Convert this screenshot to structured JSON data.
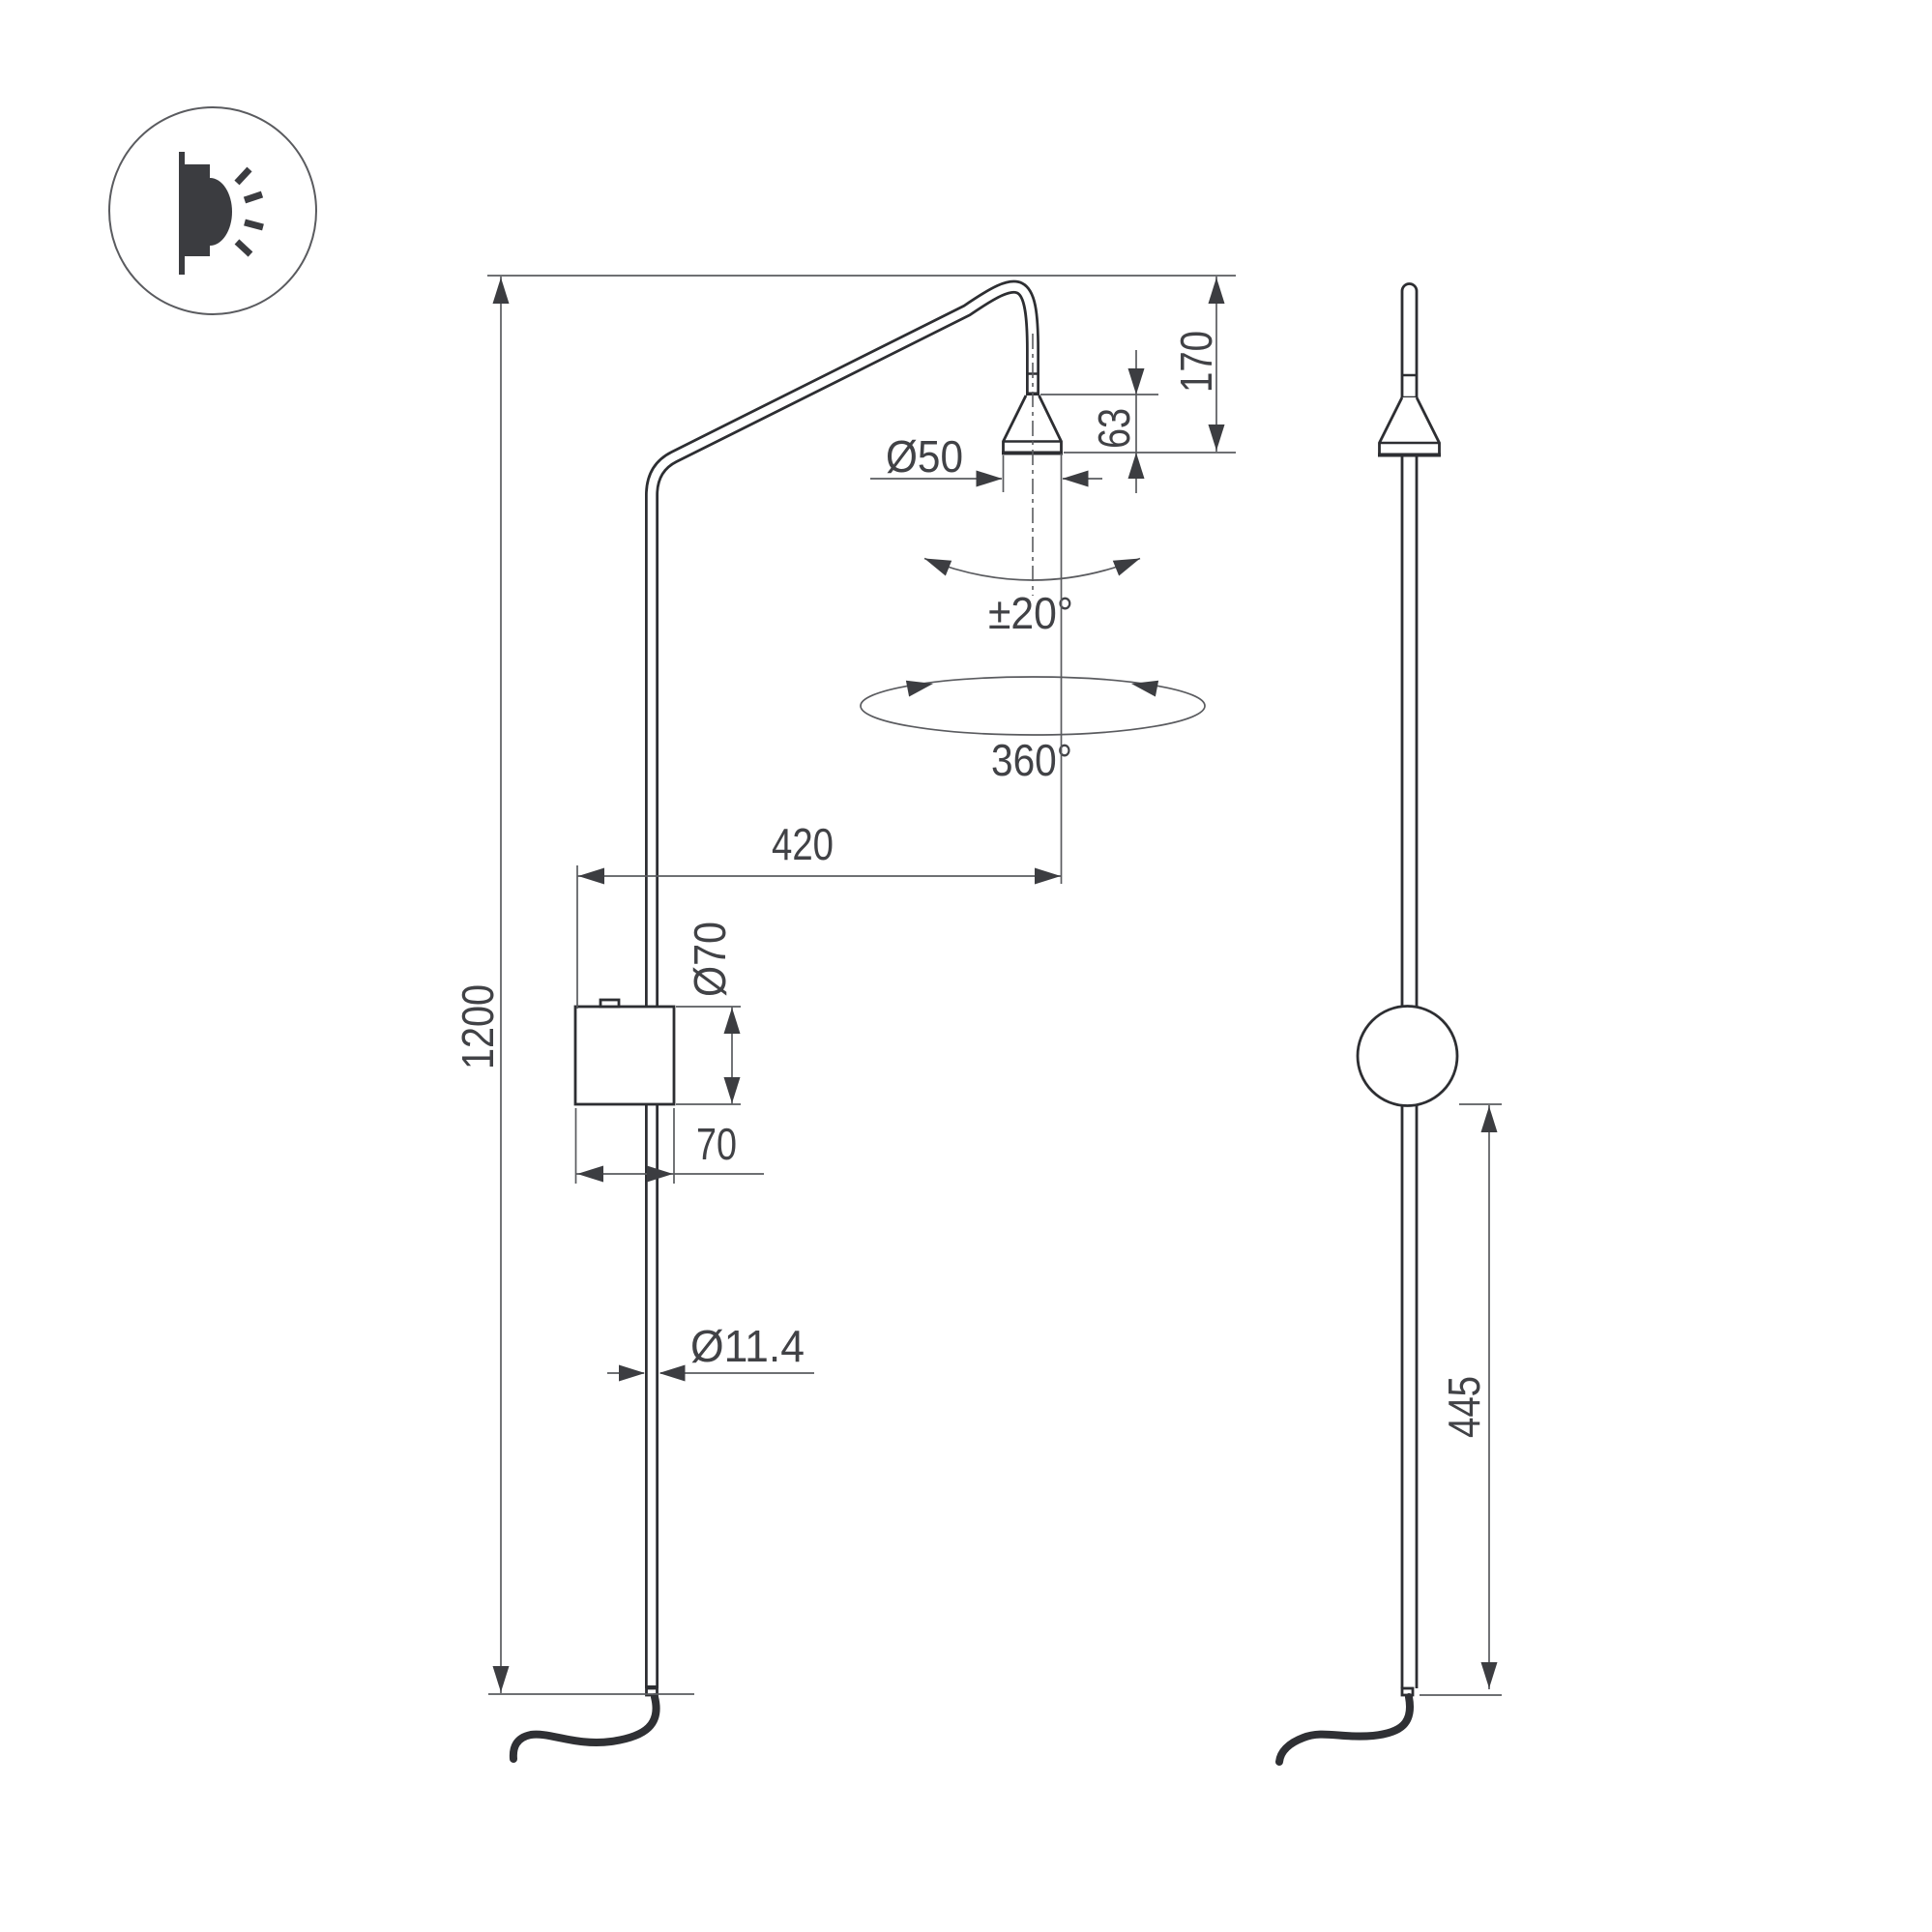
{
  "icon": {
    "name": "wall-light-emission-icon"
  },
  "views": {
    "left": "front-view-with-arm",
    "right": "side-view"
  },
  "dimensions": {
    "pole_height": "1200",
    "arm_reach": "420",
    "head_diameter": "Ø50",
    "head_height": "63",
    "head_drop": "170",
    "tilt": "±20°",
    "rotation": "360°",
    "canopy_diameter": "Ø70",
    "canopy_width": "70",
    "rod_diameter": "Ø11.4",
    "lower_height": "445"
  },
  "colors": {
    "bg": "#ffffff",
    "product": "#2d2e32",
    "dim": "#5a5b5f",
    "text": "#414246",
    "arrow": "#3c3d41",
    "cord": "#2f3034",
    "icon": "#3b3c40",
    "ring": "#5a5b5f"
  }
}
